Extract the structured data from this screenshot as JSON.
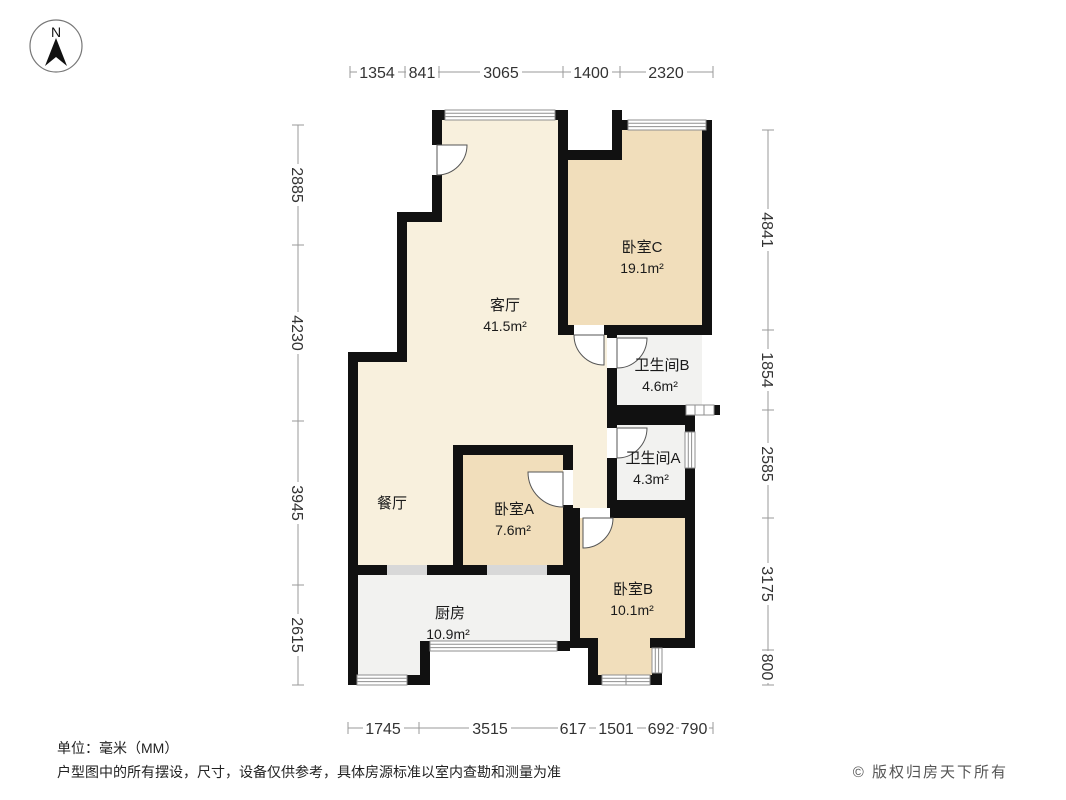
{
  "compass": {
    "label": "N"
  },
  "rooms": [
    {
      "id": "living",
      "name": "客厅",
      "area": "41.5m²"
    },
    {
      "id": "dining",
      "name": "餐厅",
      "area": ""
    },
    {
      "id": "bedroomC",
      "name": "卧室C",
      "area": "19.1m²"
    },
    {
      "id": "bathB",
      "name": "卫生间B",
      "area": "4.6m²"
    },
    {
      "id": "bathA",
      "name": "卫生间A",
      "area": "4.3m²"
    },
    {
      "id": "bedroomA",
      "name": "卧室A",
      "area": "7.6m²"
    },
    {
      "id": "bedroomB",
      "name": "卧室B",
      "area": "10.1m²"
    },
    {
      "id": "kitchen",
      "name": "厨房",
      "area": "10.9m²"
    }
  ],
  "dimensions": {
    "unit": "mm",
    "top": [
      "1354",
      "841",
      "3065",
      "1400",
      "2320"
    ],
    "bottom": [
      "1745",
      "3515",
      "617",
      "1501",
      "692",
      "790"
    ],
    "left": [
      "2885",
      "4230",
      "3945",
      "2615"
    ],
    "right": [
      "4841",
      "1854",
      "2585",
      "3175",
      "800"
    ]
  },
  "footer": {
    "unit_label": "单位：毫米（MM）",
    "disclaimer": "户型图中的所有摆设，尺寸，设备仅供参考，具体房源标准以室内查勘和测量为准",
    "copyright": "© 版权归房天下所有"
  },
  "colors": {
    "wall": "#111111",
    "room_warm": "#f1debb",
    "room_light": "#f8f0dd",
    "room_gray": "#f2f2f0",
    "dimension_line": "#9a9a9a",
    "text": "#222222"
  }
}
